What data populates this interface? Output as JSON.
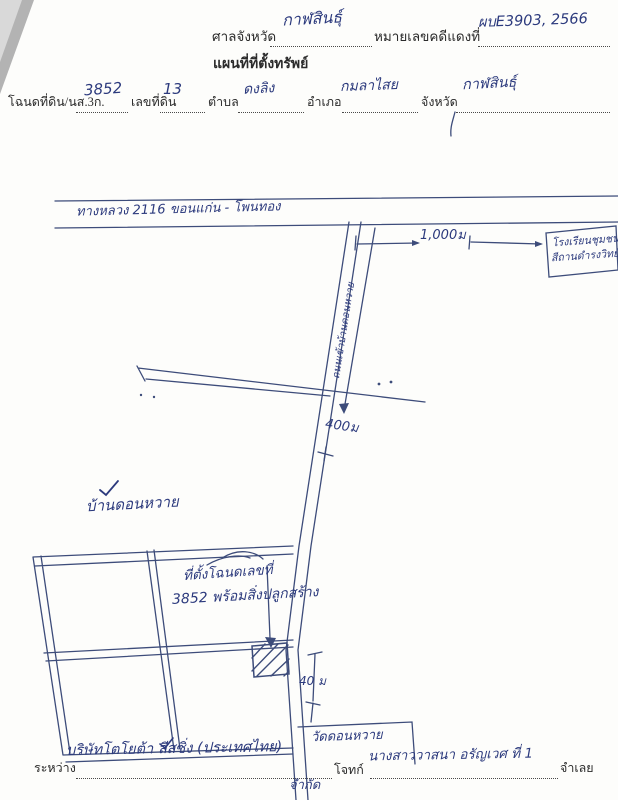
{
  "document": {
    "header": {
      "court_label": "ศาลจังหวัด",
      "court_value": "กาฬสินธุ์",
      "case_label": "หมายเลขคดีแดงที่",
      "case_value": "ผบE3903, 2566",
      "title": "แผนที่ที่ตั้งทรัพย์"
    },
    "deed_line": {
      "deed_label": "โฉนดที่ดิน/นส.3ก.",
      "deed_value": "3852",
      "parcel_label": "เลขที่ดิน",
      "parcel_value": "13",
      "subdistrict_label": "ตำบล",
      "subdistrict_value": "ดงลิง",
      "district_label": "อำเภอ",
      "district_value": "กมลาไสย",
      "province_label": "จังหวัด",
      "province_value": "กาฬสินธุ์"
    },
    "map": {
      "highway_label": "ทางหลวง 2116   ขอนแก่น - โพนทอง",
      "distance_highway": "1,000ม",
      "school_line1": "โรงเรียนชุมชน",
      "school_line2": "สีถานดำรงวิทย์",
      "access_road_label": "ถนนเข้าบ้านดอนหวาย",
      "distance_road": "400ม",
      "village_label": "บ้านดอนหวาย",
      "deed_location_line1": "ที่ตั้งโฉนดเลขที่",
      "deed_location_line2": "3852 พร้อมสิ่งปลูกสร้าง",
      "distance_frontage": "40 ม",
      "temple_label": "วัดดอนหวาย"
    },
    "footer": {
      "between_label": "ระหว่าง",
      "plaintiff_value": "บริษัทโตโยต้า ลีสซิ่ง (ประเทศไทย)",
      "plaintiff_value2": "จำกัด",
      "plaintiff_role_label": "โจทก์",
      "defendant_value": "นางสาววาสนา อรัญเวศ ที่ 1",
      "defendant_role_label": "จำเลย"
    },
    "colors": {
      "handwriting_ink": "#2c3a7d",
      "drawing_ink": "#3d4c7a",
      "printed_text": "#2b2b2b",
      "paper": "#fdfdfb"
    }
  }
}
